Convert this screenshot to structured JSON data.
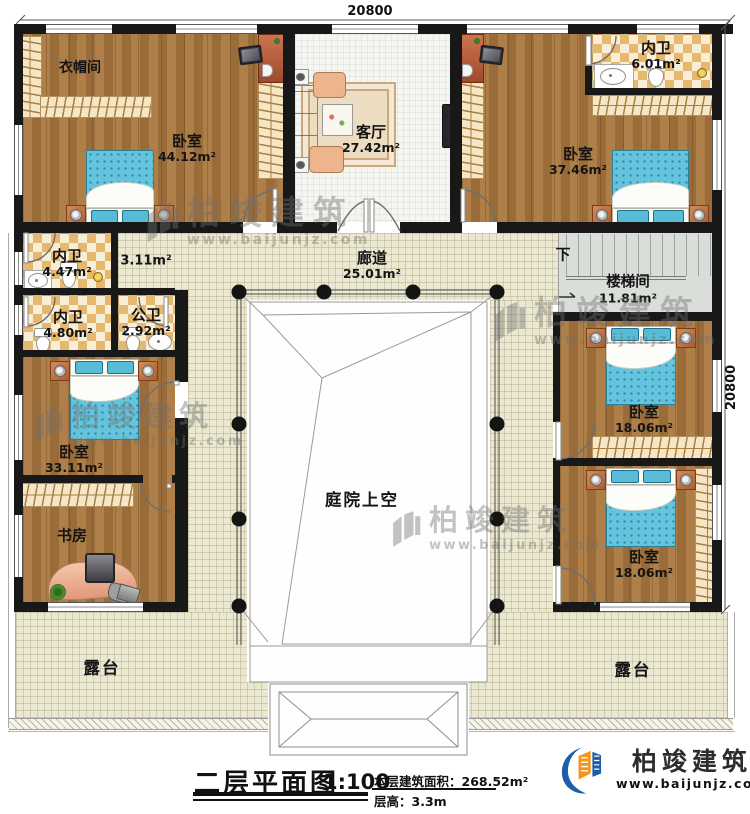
{
  "plan": {
    "dim_top": "20800",
    "dim_right": "20800",
    "rooms": {
      "cloakroom": {
        "name": "衣帽间"
      },
      "bedroom_tl": {
        "name": "卧室",
        "area": "44.12m²"
      },
      "living": {
        "name": "客厅",
        "area": "27.42m²"
      },
      "bath_tr": {
        "name": "内卫",
        "area": "6.01m²"
      },
      "bedroom_tr": {
        "name": "卧室",
        "area": "37.46m²"
      },
      "bath_l1": {
        "name": "内卫",
        "area": "4.47m²"
      },
      "hall": {
        "area": "3.11m²"
      },
      "bath_l2": {
        "name": "内卫",
        "area": "4.80m²"
      },
      "bath_pub": {
        "name": "公卫",
        "area": "2.92m²"
      },
      "corridor": {
        "name": "廊道",
        "area": "25.01m²"
      },
      "stairwell": {
        "name": "楼梯间",
        "area": "11.81m²",
        "down_label": "下"
      },
      "bedroom_ml": {
        "name": "卧室",
        "area": "33.11m²"
      },
      "study": {
        "name": "书房"
      },
      "bedroom_r1": {
        "name": "卧室",
        "area": "18.06m²"
      },
      "bedroom_r2": {
        "name": "卧室",
        "area": "18.06m²"
      },
      "courtyard": {
        "name": "庭院上空"
      },
      "terrace_l": {
        "name": "露台"
      },
      "terrace_r": {
        "name": "露台"
      }
    }
  },
  "watermark": {
    "brand": "柏竣建筑",
    "url": "www.baijunjz.com"
  },
  "titleblock": {
    "title": "二层平面图",
    "scale": "1:100",
    "area_label": "本层建筑面积：268.52m²",
    "floor_height": "层高：3.3m"
  },
  "logo": {
    "brand": "柏竣建筑",
    "url": "www.baijunjz.com"
  },
  "colors": {
    "wood": "#a5743d",
    "tile": "#ebe8d2",
    "checker": "#e6b86d",
    "bed_blue": "#64c4dd",
    "logo_orange": "#f7941e",
    "logo_blue": "#1c5ea9"
  }
}
